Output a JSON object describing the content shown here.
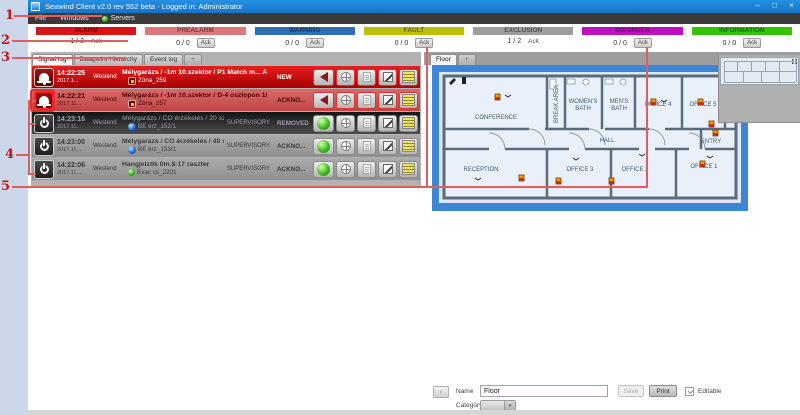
{
  "annotation_labels": [
    "1",
    "2",
    "3",
    "4",
    "5"
  ],
  "window": {
    "title": "Seawind Client v2.0 rev 552 beta - Logged in: Administrator",
    "menu": {
      "file": "File",
      "windows": "Windows",
      "servers": "Servers"
    },
    "controls": {
      "minimize": "–",
      "maximize": "□",
      "close": "×"
    }
  },
  "status": {
    "categories": [
      {
        "label": "ALARM",
        "count": "1 / 2",
        "ack": "Ack",
        "color": "#d61616",
        "ack_is_button": false
      },
      {
        "label": "PREALARM",
        "count": "0 / 0",
        "ack": "Ack",
        "color": "#dd7878",
        "ack_is_button": true
      },
      {
        "label": "WARNING",
        "count": "0 / 0",
        "ack": "Ack",
        "color": "#2f6fae",
        "ack_is_button": true
      },
      {
        "label": "FAULT",
        "count": "0 / 0",
        "ack": "Ack",
        "color": "#bfbf0a",
        "ack_is_button": true
      },
      {
        "label": "EXCLUSION",
        "count": "1 / 2",
        "ack": "Ack",
        "color": "#9d9d9d",
        "ack_is_button": false
      },
      {
        "label": "DISORDER",
        "count": "0 / 0",
        "ack": "Ack",
        "color": "#bf10bf",
        "ack_is_button": true
      },
      {
        "label": "INFORMATION",
        "count": "0 / 0",
        "ack": "Ack",
        "color": "#35c30a",
        "ack_is_button": true
      }
    ]
  },
  "signal_panel": {
    "tabs": {
      "signal_log": "Signal log",
      "datapoint_hierarchy": "Datapoint Hierarchy",
      "event_log": "Event log",
      "add": "+"
    },
    "rows": [
      {
        "time": "14:22:25",
        "date": "2017.1...",
        "site": "Westend",
        "title": "Mélygarázs / -1m 10.szektor / P1 Match m... ALARM",
        "subtitle": "Zóna_259",
        "supervisory": "",
        "state": "NEW"
      },
      {
        "time": "14:22:21",
        "date": "2017.11...",
        "site": "Westend",
        "title": "Mélygarázs / -1m 10.szektor / D-4 oszlopon 1/110... ALARM",
        "subtitle": "Zóna_257",
        "supervisory": "",
        "state": "ACKNO..."
      },
      {
        "time": "14:23:16",
        "date": "2017.11...",
        "site": "Westend",
        "title": "Mélygarázs / CO érzékelés / 20 százalék 1/114/1",
        "subtitle": "BE érz_152/1",
        "supervisory": "SUPERVISORY",
        "state": "REMOVED"
      },
      {
        "time": "14:23:00",
        "date": "2017.11...",
        "site": "Westend",
        "title": "Mélygarázs / CO érzékelés / 40 százalék 1/114/2 / ...",
        "subtitle": "BE érz_153/1",
        "supervisory": "SUPERVISORY",
        "state": "ACKNO..."
      },
      {
        "time": "14:22:06",
        "date": "2017.11...",
        "site": "Westend",
        "title": "Hangjelzők 0m.$-17 raszter",
        "subtitle": "Évac cs_2201",
        "supervisory": "SUPERVISORY",
        "state": "ACKNO..."
      }
    ]
  },
  "map_panel": {
    "tabs": {
      "floor": "Floor",
      "add": "+"
    },
    "rooms": {
      "conference": "CONFERENCE",
      "break_area": "BREAK AREA",
      "womens_bath_l1": "WOMEN'S",
      "womens_bath_l2": "BATH",
      "mens_bath_l1": "MEN'S",
      "mens_bath_l2": "BATH",
      "office4": "OFFICE 4",
      "office5": "OFFICE 5",
      "media": "MEDIA R...",
      "hall": "HALL",
      "entry": "ENTRY",
      "reception": "RECEPTION",
      "office3": "OFFICE 3",
      "office2": "OFFICE 2",
      "office1": "OFFICE 1"
    },
    "footer": {
      "back": "‹",
      "name_label": "Name",
      "name_value": "Floor",
      "save_label": "Save",
      "print_label": "Print",
      "editable_label": "Editable",
      "category_label": "Category"
    }
  }
}
